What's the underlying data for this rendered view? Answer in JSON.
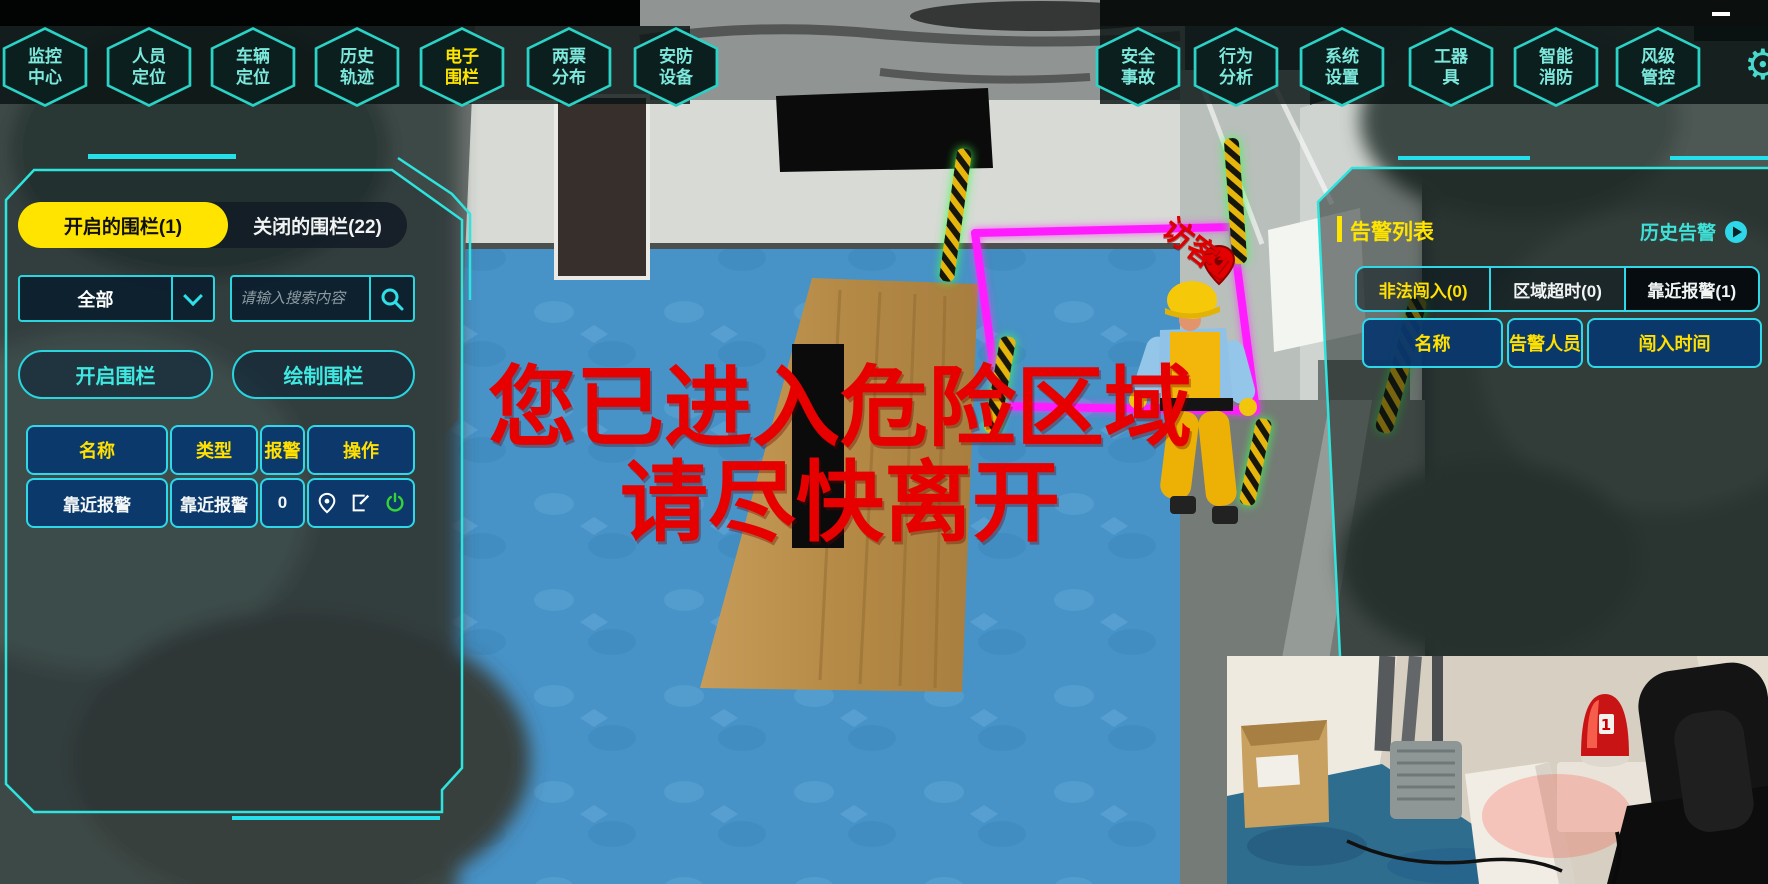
{
  "nav": {
    "items": [
      {
        "label": "监控\n中心",
        "active": false
      },
      {
        "label": "人员\n定位",
        "active": false
      },
      {
        "label": "车辆\n定位",
        "active": false
      },
      {
        "label": "历史\n轨迹",
        "active": false
      },
      {
        "label": "电子\n围栏",
        "active": true
      },
      {
        "label": "两票\n分布",
        "active": false
      },
      {
        "label": "安防\n设备",
        "active": false
      },
      {
        "label": "安全\n事故",
        "active": false
      },
      {
        "label": "行为\n分析",
        "active": false
      },
      {
        "label": "系统\n设置",
        "active": false
      },
      {
        "label": "工器\n具",
        "active": false
      },
      {
        "label": "智能\n消防",
        "active": false
      },
      {
        "label": "风级\n管控",
        "active": false
      }
    ]
  },
  "left_panel": {
    "tabs": [
      {
        "label": "开启的围栏(1)",
        "active": true
      },
      {
        "label": "关闭的围栏(22)",
        "active": false
      }
    ],
    "filter": {
      "value": "全部"
    },
    "search": {
      "placeholder": "请输入搜索内容"
    },
    "actions": {
      "open": "开启围栏",
      "draw": "绘制围栏"
    },
    "table": {
      "headers": [
        "名称",
        "类型",
        "报警",
        "操作"
      ],
      "rows": [
        {
          "name": "靠近报警",
          "type": "靠近报警",
          "alarm": "0"
        }
      ]
    }
  },
  "right_panel": {
    "title": "告警列表",
    "history_link": "历史告警",
    "tabs": [
      {
        "label": "非法闯入(0)",
        "active": true
      },
      {
        "label": "区域超时(0)",
        "active": false
      },
      {
        "label": "靠近报警(1)",
        "active": false
      }
    ],
    "table": {
      "headers": [
        "名称",
        "告警人员",
        "闯入时间"
      ],
      "rows": []
    }
  },
  "overlay": {
    "warning_line1": "您已进入危险区域",
    "warning_line2": "请尽快离开",
    "visitor_label": "访客1"
  },
  "colors": {
    "accent_cyan": "#2fd8e8",
    "accent_yellow": "#ffe400",
    "alert_red": "#e70000",
    "table_blue": "#0a3a6e",
    "fence_magenta": "#ff1cff"
  }
}
